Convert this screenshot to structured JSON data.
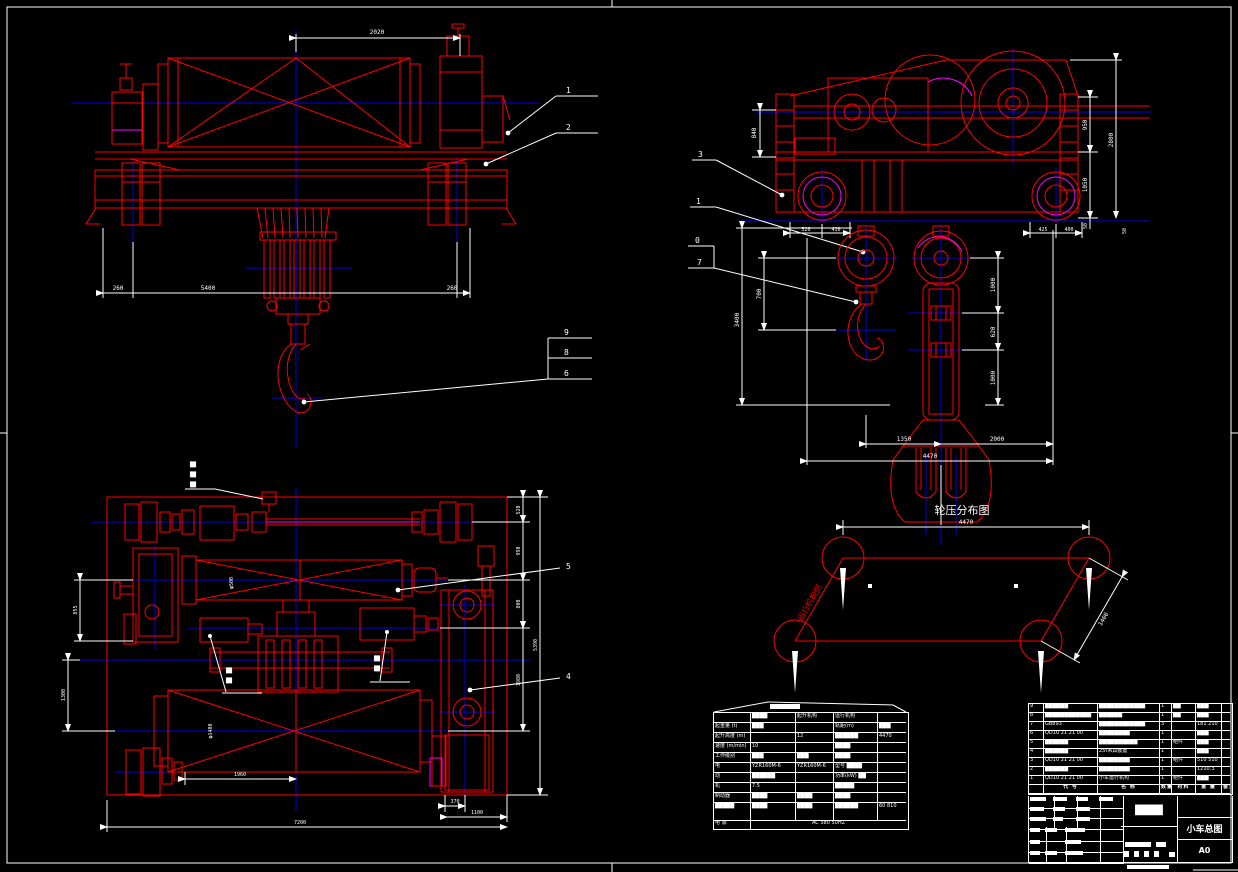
{
  "colors": {
    "line_red": "#ff0000",
    "line_blue": "#0000e0",
    "line_magenta": "#ff00ff",
    "line_white": "#ffffff",
    "background": "#000000"
  },
  "front_view": {
    "dim_top": "2020",
    "dim_left": "260",
    "dim_mid": "5400",
    "dim_right": "260",
    "balloon_1": "1",
    "balloon_2": "2",
    "balloon_9": "9",
    "balloon_8": "8",
    "balloon_6": "6"
  },
  "side_view": {
    "dim_840": "840",
    "dim_950": "950",
    "dim_1050": "1050",
    "dim_50a": "50",
    "dim_2800": "2800",
    "dim_520": "520",
    "dim_410": "410",
    "dim_425": "425",
    "dim_400": "400",
    "dim_50b": "50",
    "balloon_3": "3",
    "balloon_1": "1",
    "balloon_0": "0",
    "balloon_7": "7"
  },
  "hook_view": {
    "dim_3400": "3400",
    "dim_700": "700",
    "dim_1000a": "1000",
    "dim_620": "620",
    "dim_1000b": "1000",
    "dim_1350": "1350",
    "dim_2000": "2000",
    "dim_4470": "4470"
  },
  "plan_view": {
    "dim_520": "520",
    "dim_990": "990",
    "dim_800": "800",
    "dim_1980": "1980",
    "dim_5390": "5390",
    "dim_855": "855",
    "dim_1300": "1300",
    "dim_1960": "1960",
    "dim_370": "370",
    "dim_1100": "1100",
    "dim_7200": "7200",
    "drum1_dia": "φ500",
    "drum2_dia": "φ1400",
    "balloon_5": "5",
    "balloon_4": "4",
    "note1": "██",
    "note2": "██",
    "note3": "██"
  },
  "wheel_diagram": {
    "title": "轮压分布图",
    "dim_top": "4470",
    "dim_diag": "1400",
    "side_label": "运行机构侧"
  },
  "spec_table": {
    "rows": [
      [
        "",
        "████",
        "起升机构",
        "运行机构",
        ""
      ],
      [
        "起重量 (t)",
        "███",
        "",
        "轨距(m)",
        "███"
      ],
      [
        "起升高度 (m)",
        "",
        "12",
        "██████",
        "4470"
      ],
      [
        "速度 (m/min)",
        "10",
        "",
        "████",
        ""
      ],
      [
        "工作级别",
        "███",
        "███",
        "████",
        ""
      ],
      [
        "电",
        "YZR160M-6",
        "YZR160M-6",
        "型号 ████",
        ""
      ],
      [
        "动",
        "██████",
        "",
        "功率(kW) ██",
        ""
      ],
      [
        "机",
        "7.5",
        "",
        "█████",
        ""
      ],
      [
        "制动器",
        "████",
        "████",
        "████",
        ""
      ],
      [
        "█████",
        "████",
        "████",
        "██████",
        "60 810"
      ],
      [
        "电 源",
        "AC 380 50HZ",
        "",
        "",
        ""
      ]
    ]
  },
  "bom": {
    "headers": [
      "",
      "代 号",
      "名 称",
      "数量",
      "材料",
      "重 量",
      "备注"
    ],
    "rows": [
      {
        "seq": "9",
        "code": "██████",
        "name": "████████████",
        "qty": "1",
        "mat": "██",
        "wt": "███",
        "rm": ""
      },
      {
        "seq": "8",
        "code": "████████████",
        "name": "██████",
        "qty": "1",
        "mat": "██",
        "wt": "███",
        "rm": ""
      },
      {
        "seq": "7",
        "code": "GB893",
        "name": "████████████",
        "qty": "3",
        "mat": "",
        "wt": "181 210",
        "rm": ""
      },
      {
        "seq": "6",
        "code": "QD10 21 21 00",
        "name": "████████",
        "qty": "1",
        "mat": "",
        "wt": "███",
        "rm": ""
      },
      {
        "seq": "5",
        "code": "██████",
        "name": "██████████",
        "qty": "1",
        "mat": "组件",
        "wt": "███",
        "rm": ""
      },
      {
        "seq": "4",
        "code": "██████",
        "name": "25t吊具装置",
        "qty": "1",
        "mat": "",
        "wt": "███",
        "rm": ""
      },
      {
        "seq": "3",
        "code": "QD10 21 21 00",
        "name": "████████",
        "qty": "1",
        "mat": "组件",
        "wt": "510 510",
        "rm": ""
      },
      {
        "seq": "2",
        "code": "██████",
        "name": "████████",
        "qty": "1",
        "mat": "",
        "wt": "1210.3",
        "rm": ""
      },
      {
        "seq": "1",
        "code": "QD10 21 21 00",
        "name": "小车运行机构",
        "qty": "1",
        "mat": "组件",
        "wt": "███",
        "rm": ""
      }
    ]
  },
  "title_block": {
    "name_cell": "████",
    "drawing_title": "小车总图",
    "sheet_size": "A0"
  }
}
